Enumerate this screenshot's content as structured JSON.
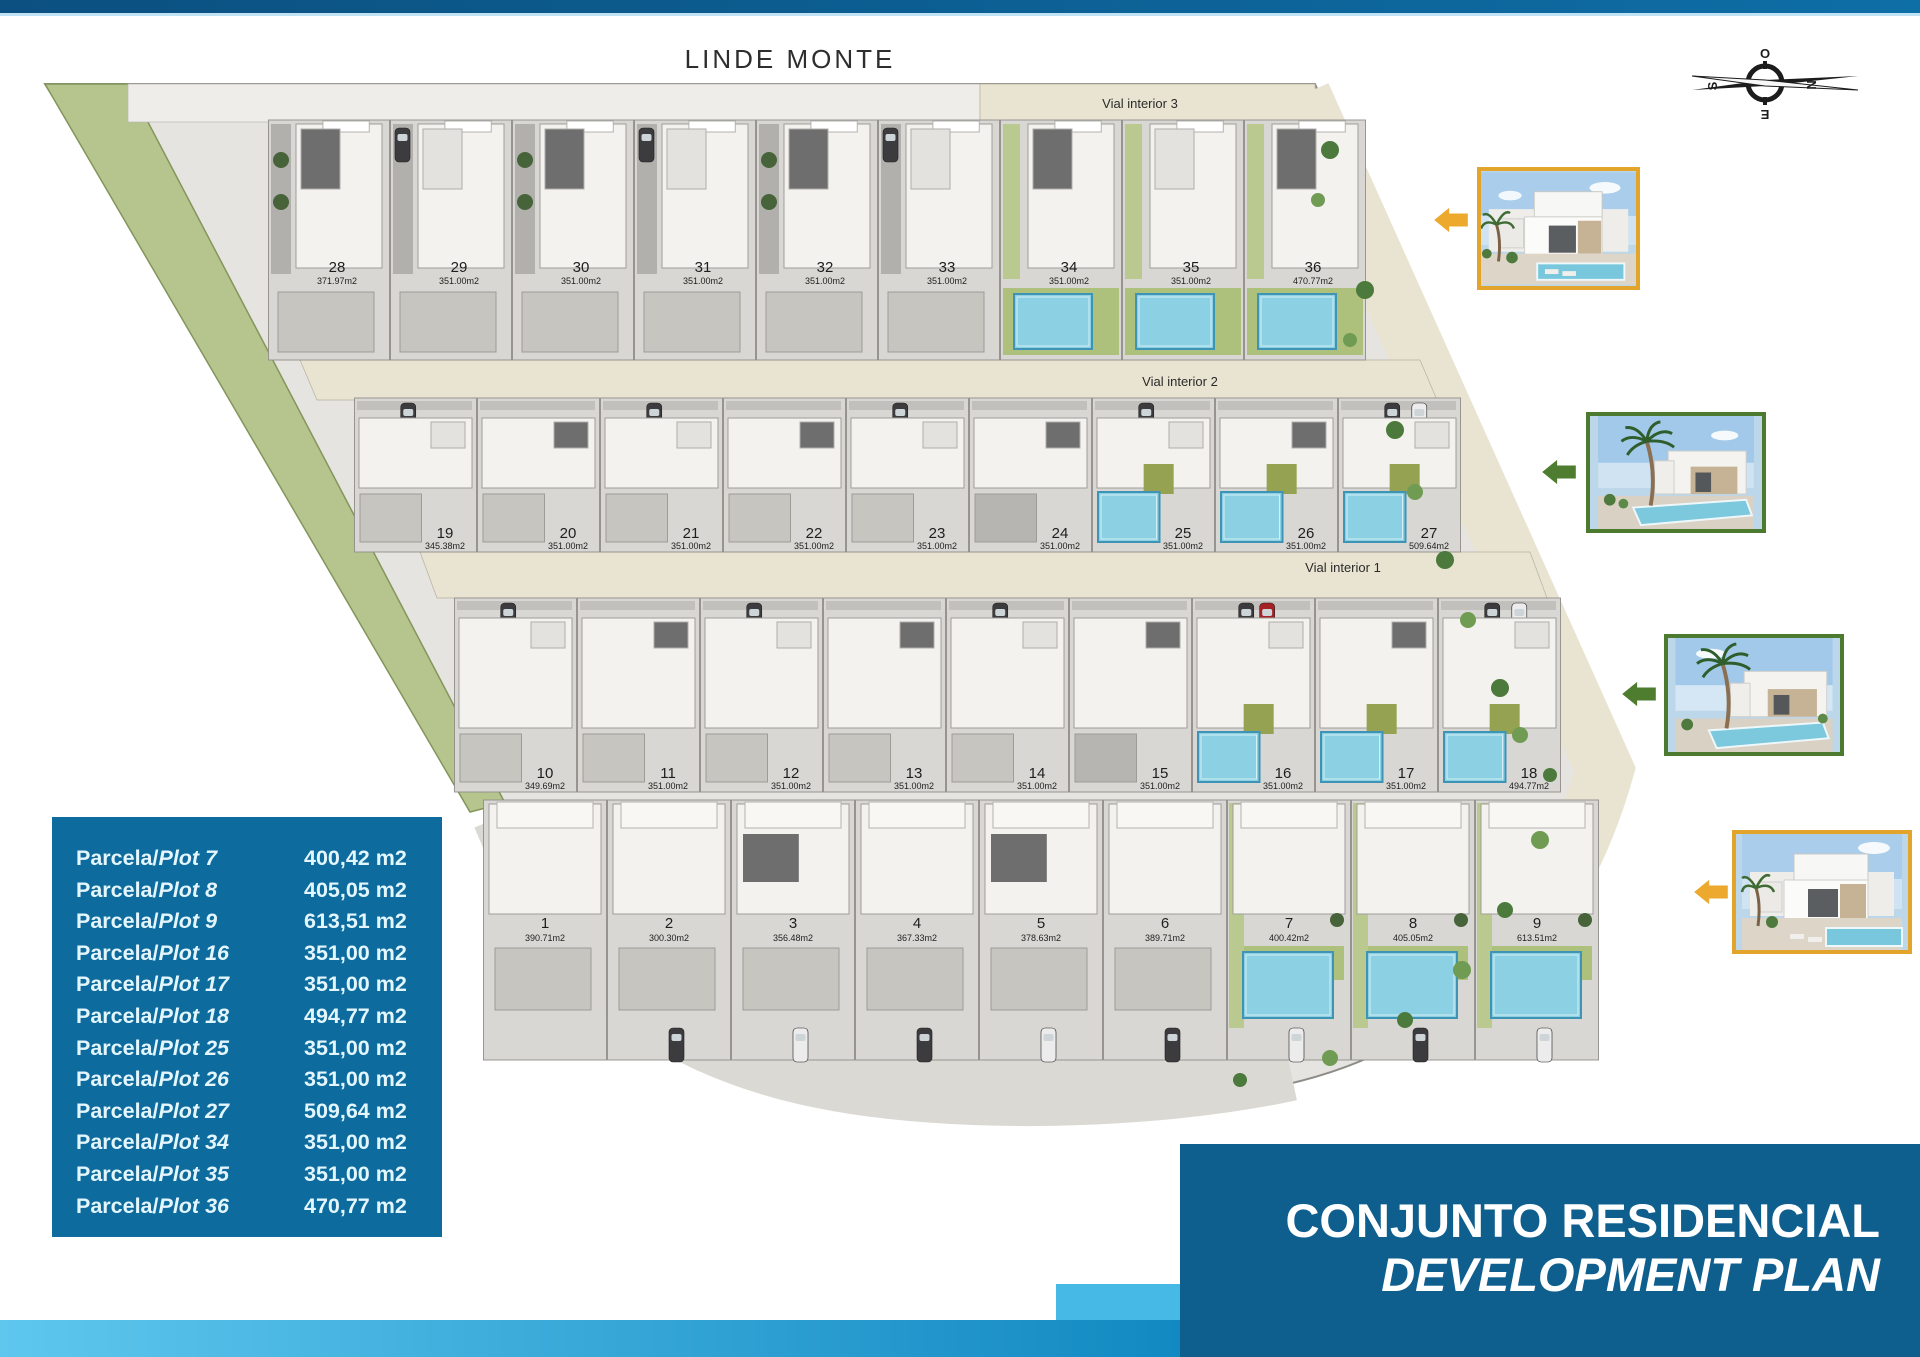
{
  "page": {
    "top_label": "LINDE MONTE"
  },
  "colors": {
    "top_bar": "#0b5080",
    "accent_cyan": "#2fa8dc",
    "legend_blue": "#0d6b9d",
    "title_blue": "#0f5f8e",
    "site_gray": "#e6e4e0",
    "cell_gray": "#d9d7d3",
    "road_beige": "#e9e4d2",
    "green_strip": "#b5c58d",
    "house_white": "#f3f2ef",
    "house_dark": "#6e6e6e",
    "lawn_green": "#adc17d",
    "strip_green": "#b9c98f",
    "olive": "#94a251",
    "pool_blue": "#8bd0e3",
    "pool_border": "#3f93b5",
    "tree_green": "#47633a",
    "edge_tree": "#4c7a3c",
    "gold": "#e2a42b",
    "green_arrow": "#4e7d2f",
    "red_car": "#a62125",
    "car_dark": "#3c3c3e",
    "car_white": "#ececec"
  },
  "compass": {
    "top": "O",
    "right": "N",
    "bottom": "E",
    "left": "S"
  },
  "roads": [
    {
      "label": "Vial interior 3"
    },
    {
      "label": "Vial interior 2"
    },
    {
      "label": "Vial interior 1"
    }
  ],
  "legend": {
    "rows": [
      {
        "parcela": "Parcela/",
        "plot": "Plot 7",
        "area": "400,42 m2"
      },
      {
        "parcela": "Parcela/",
        "plot": "Plot 8",
        "area": "405,05 m2"
      },
      {
        "parcela": "Parcela/",
        "plot": "Plot 9",
        "area": "613,51 m2"
      },
      {
        "parcela": "Parcela/",
        "plot": "Plot 16",
        "area": "351,00 m2"
      },
      {
        "parcela": "Parcela/",
        "plot": "Plot 17",
        "area": "351,00 m2"
      },
      {
        "parcela": "Parcela/",
        "plot": "Plot 18",
        "area": "494,77 m2"
      },
      {
        "parcela": "Parcela/",
        "plot": "Plot 25",
        "area": "351,00 m2"
      },
      {
        "parcela": "Parcela/",
        "plot": "Plot 26",
        "area": "351,00 m2"
      },
      {
        "parcela": "Parcela/",
        "plot": "Plot 27",
        "area": "509,64 m2"
      },
      {
        "parcela": "Parcela/",
        "plot": "Plot 34",
        "area": "351,00 m2"
      },
      {
        "parcela": "Parcela/",
        "plot": "Plot 35",
        "area": "351,00 m2"
      },
      {
        "parcela": "Parcela/",
        "plot": "Plot 36",
        "area": "470,77 m2"
      }
    ]
  },
  "title_block": {
    "line1": "CONJUNTO RESIDENCIAL",
    "line2": "DEVELOPMENT PLAN"
  },
  "plan": {
    "rows": [
      {
        "cells": [
          {
            "n": "28",
            "a": "371.97m2"
          },
          {
            "n": "29",
            "a": "351.00m2"
          },
          {
            "n": "30",
            "a": "351.00m2"
          },
          {
            "n": "31",
            "a": "351.00m2"
          },
          {
            "n": "32",
            "a": "351.00m2"
          },
          {
            "n": "33",
            "a": "351.00m2"
          },
          {
            "n": "34",
            "a": "351.00m2",
            "hl": true
          },
          {
            "n": "35",
            "a": "351.00m2",
            "hl": true
          },
          {
            "n": "36",
            "a": "470.77m2",
            "hl": true
          }
        ]
      },
      {
        "cells": [
          {
            "n": "19",
            "a": "345.38m2"
          },
          {
            "n": "20",
            "a": "351.00m2"
          },
          {
            "n": "21",
            "a": "351.00m2"
          },
          {
            "n": "22",
            "a": "351.00m2"
          },
          {
            "n": "23",
            "a": "351.00m2"
          },
          {
            "n": "24",
            "a": "351.00m2"
          },
          {
            "n": "25",
            "a": "351.00m2",
            "hl": true
          },
          {
            "n": "26",
            "a": "351.00m2",
            "hl": true
          },
          {
            "n": "27",
            "a": "509.64m2",
            "hl": true
          }
        ]
      },
      {
        "cells": [
          {
            "n": "10",
            "a": "349.69m2"
          },
          {
            "n": "11",
            "a": "351.00m2"
          },
          {
            "n": "12",
            "a": "351.00m2"
          },
          {
            "n": "13",
            "a": "351.00m2"
          },
          {
            "n": "14",
            "a": "351.00m2"
          },
          {
            "n": "15",
            "a": "351.00m2"
          },
          {
            "n": "16",
            "a": "351.00m2",
            "hl": true
          },
          {
            "n": "17",
            "a": "351.00m2",
            "hl": true
          },
          {
            "n": "18",
            "a": "494.77m2",
            "hl": true
          }
        ]
      },
      {
        "cells": [
          {
            "n": "1",
            "a": "390.71m2"
          },
          {
            "n": "2",
            "a": "300.30m2"
          },
          {
            "n": "3",
            "a": "356.48m2"
          },
          {
            "n": "4",
            "a": "367.33m2"
          },
          {
            "n": "5",
            "a": "378.63m2"
          },
          {
            "n": "6",
            "a": "389.71m2"
          },
          {
            "n": "7",
            "a": "400.42m2",
            "hl": true
          },
          {
            "n": "8",
            "a": "405.05m2",
            "hl": true
          },
          {
            "n": "9",
            "a": "613.51m2",
            "hl": true
          }
        ]
      }
    ]
  },
  "photos": [
    {
      "name": "villa-photo-1",
      "border": "#e2a42b",
      "arrow": "#eca92e",
      "variant": "villa"
    },
    {
      "name": "villa-photo-2",
      "border": "#4c7a2e",
      "arrow": "#4e7d2f",
      "variant": "palm"
    },
    {
      "name": "villa-photo-3",
      "border": "#4c7a2e",
      "arrow": "#4e7d2f",
      "variant": "palm"
    },
    {
      "name": "villa-photo-4",
      "border": "#e2a42b",
      "arrow": "#eca92e",
      "variant": "villa"
    }
  ]
}
